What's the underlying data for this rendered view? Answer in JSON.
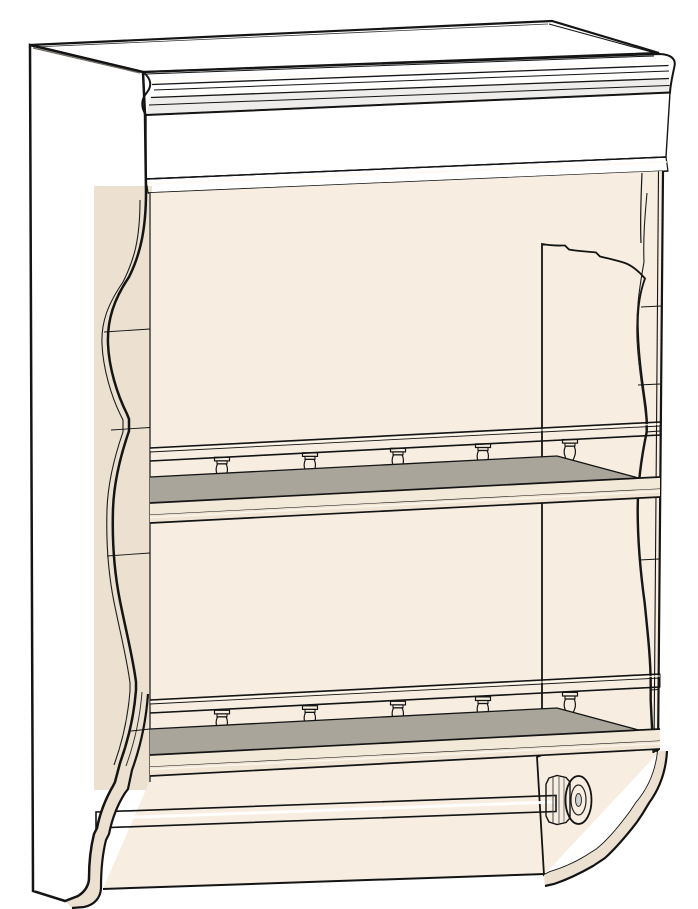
{
  "scene": {
    "kind": "3d-cad-render",
    "object": "wall-mounted plate shelf with spindle galleries and towel bar",
    "view": "front perspective, viewed slightly from the left and above",
    "background": "#ffffff"
  },
  "colors": {
    "bg": "#ffffff",
    "dark": "#49453d",
    "dark_bevel": "#6e6960",
    "cream": "#f7eee1",
    "cream_shade": "#f3e9d9",
    "cream_band": "#ece1d0",
    "top": "#a49d93",
    "shelf": "#aaa59a",
    "line": "#141414",
    "highlight": "#fffaf0",
    "chrome_dark": "#6f6f6f",
    "chrome_light": "#ffffff"
  },
  "model": {
    "parts": [
      "crown-molding-top",
      "frieze-board",
      "scalloped-arch-valance",
      "left-side-panel",
      "right-side-panel",
      "upper-shelf-with-gallery-rail",
      "lower-shelf-with-gallery-rail",
      "front-apron",
      "towel-bar",
      "ogee-bottom-brackets"
    ],
    "shelf_count": 2,
    "spindles_per_shelf": 5,
    "spindle_x_positions": [
      222,
      310,
      398,
      483,
      570
    ],
    "towel_bar_finish": "chrome",
    "wood_finish": "cream paint"
  }
}
